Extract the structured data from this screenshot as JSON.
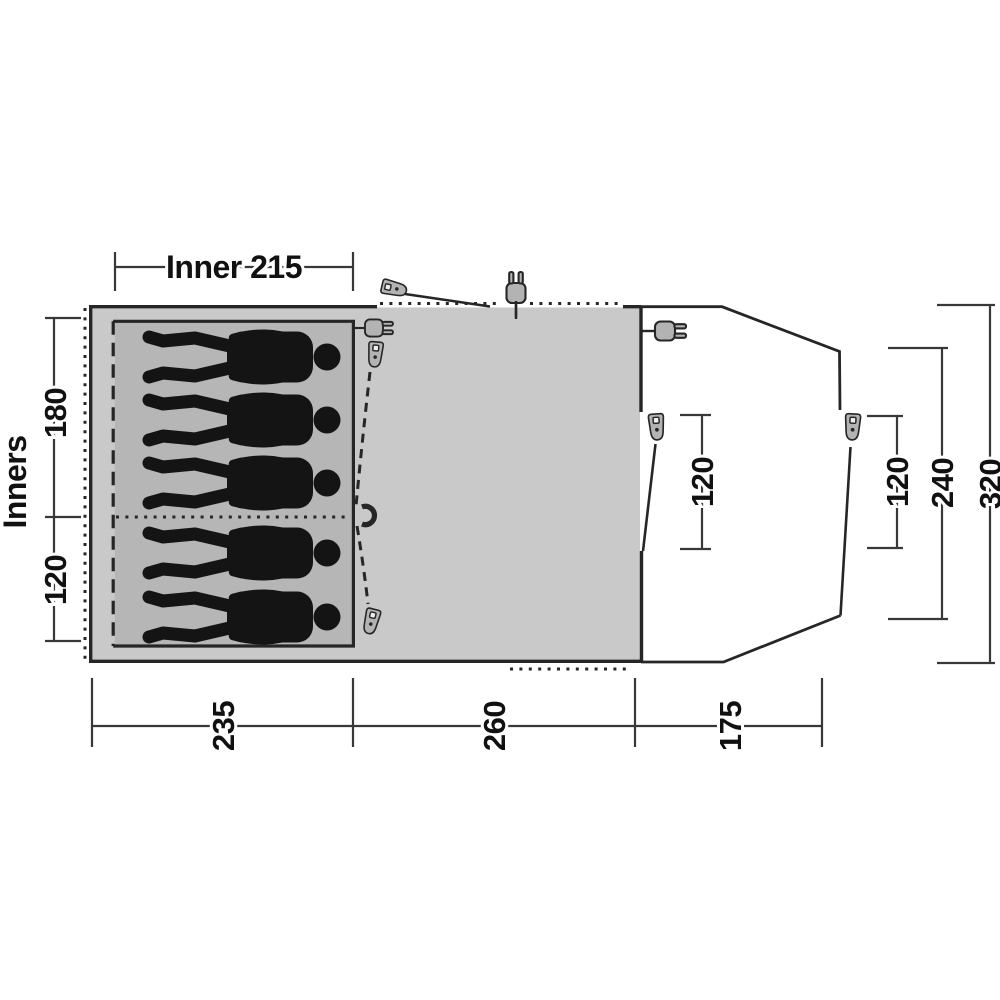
{
  "diagram": {
    "type": "tent-floorplan-top-view",
    "sleeper_count": 5,
    "top": {
      "label": "Inner 215"
    },
    "left": {
      "axis_label": "Inners",
      "values": [
        "180",
        "120"
      ]
    },
    "bottom": {
      "values": [
        "235",
        "260",
        "175"
      ]
    },
    "right": {
      "values": [
        "120",
        "120",
        "240",
        "320"
      ]
    },
    "icons": [
      "zipper-puller",
      "power-plug",
      "toggle-hook"
    ],
    "colors": {
      "background": "#ffffff",
      "tent_fill": "#c9c9c9",
      "inner_fill": "#b6b6b6",
      "outline": "#262626",
      "icon_fill": "#b3b3b3",
      "figure": "#141414",
      "dimension_line": "#383838",
      "text": "#111111"
    }
  }
}
